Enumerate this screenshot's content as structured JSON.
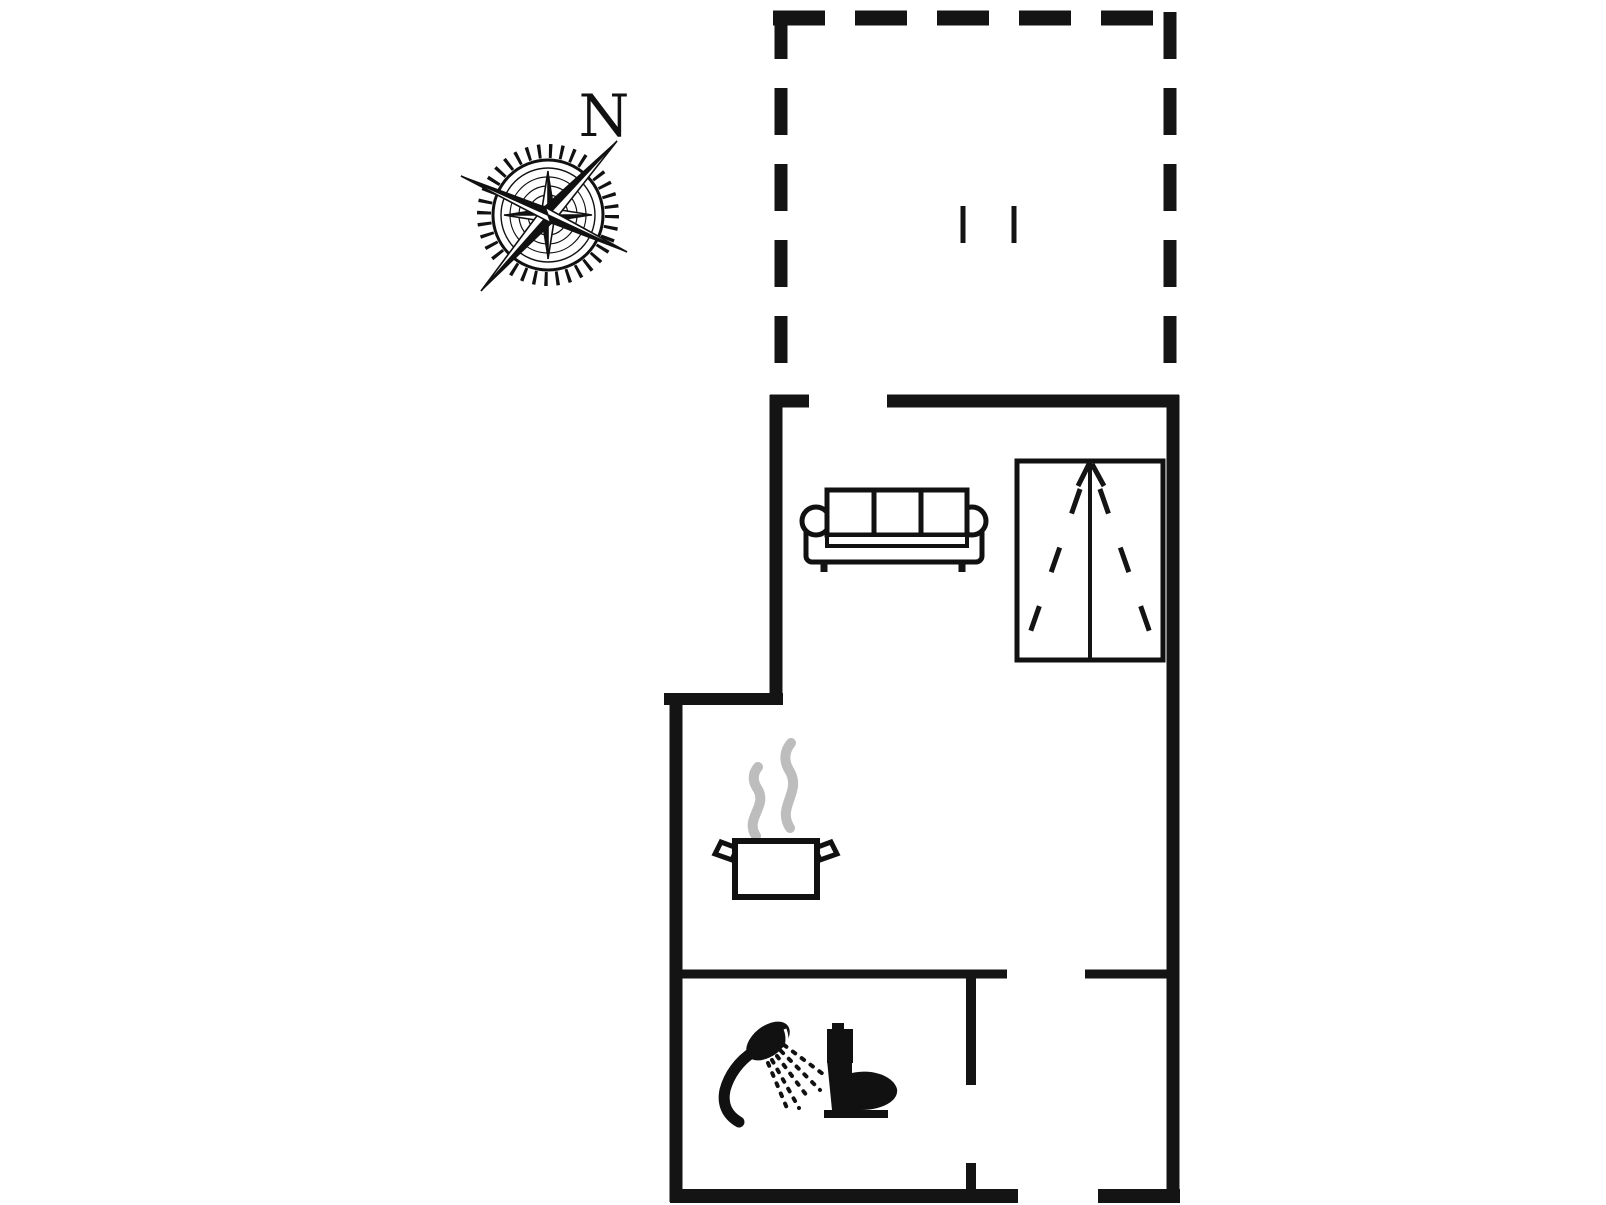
{
  "document": {
    "kind": "floor-plan-drawing",
    "background_color": "#ffffff"
  },
  "compass": {
    "north_label": "N"
  },
  "colors": {
    "wall": "#141414",
    "ink": "#111111",
    "steam": "#bdbdbd",
    "background": "#ffffff"
  },
  "icons": [
    {
      "name": "compass-rose-icon",
      "glyph": "ornate 8-point compass rose with tick ring"
    },
    {
      "name": "north-label",
      "glyph": "N"
    },
    {
      "name": "sofa-icon",
      "glyph": "three-seat sofa seen from above"
    },
    {
      "name": "wardrobe-icon",
      "glyph": "double-door wardrobe with dashed door-swing lines"
    },
    {
      "name": "cooking-pot-icon",
      "glyph": "cooking pot with two handles"
    },
    {
      "name": "steam-icon",
      "glyph": "two rising steam wisps"
    },
    {
      "name": "shower-icon",
      "glyph": "hand shower head with dotted spray"
    },
    {
      "name": "toilet-icon",
      "glyph": "toilet silhouette, side view"
    },
    {
      "name": "terrace-door-marks",
      "glyph": "two short tick marks"
    }
  ],
  "structure": {
    "terrace_outline": "dashed rectangle, open toward house",
    "house_outline": "solid thick walls with door openings",
    "interior": "partition walls with door openings near bathroom"
  }
}
